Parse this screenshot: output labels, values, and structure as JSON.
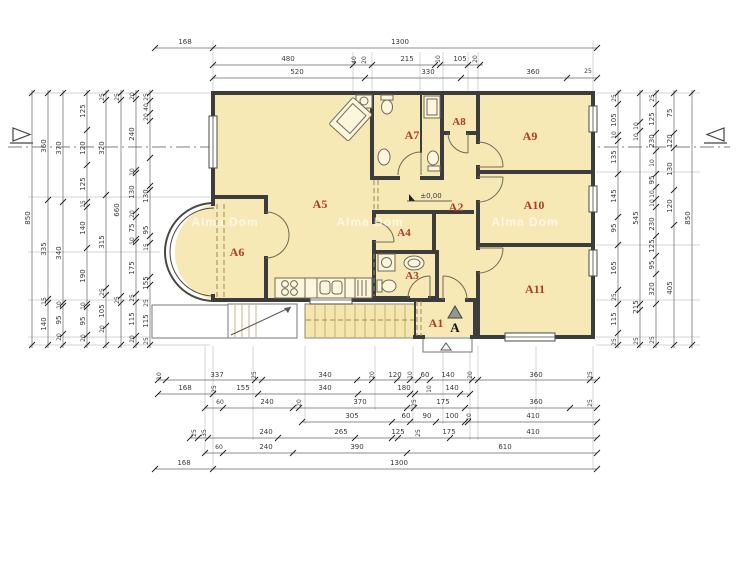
{
  "drawing": {
    "watermark": "Alma Dom",
    "level_marker": "±0,00",
    "section_letter": "A"
  },
  "colors": {
    "room_fill": "#f7e9b5",
    "label_red": "#b03a30",
    "wall": "#3c3c3c",
    "background": "#ffffff"
  },
  "rooms": {
    "a1": "A1",
    "a2": "A2",
    "a3": "A3",
    "a4": "A4",
    "a5": "A5",
    "a6": "A6",
    "a7": "A7",
    "a8": "A8",
    "a9": "A9",
    "a10": "A10",
    "a11": "A11"
  },
  "dims": {
    "t1": [
      "168",
      "1300"
    ],
    "t2": [
      "480",
      "40",
      "20",
      "215",
      "10",
      "105",
      "20"
    ],
    "t3": [
      "520",
      "330",
      "360",
      "25"
    ],
    "b1": [
      "10",
      "337",
      "25",
      "340",
      "20",
      "120",
      "10",
      "60",
      "140",
      "20",
      "360",
      "25"
    ],
    "b2": [
      "168",
      "25",
      "155",
      "340",
      "180",
      "10",
      "140"
    ],
    "b3": [
      "60",
      "240",
      "20",
      "370",
      "25",
      "175",
      "360",
      "25"
    ],
    "b4": [
      "305",
      "60",
      "90",
      "100",
      "10",
      "410"
    ],
    "b5": [
      "25",
      "35",
      "240",
      "265",
      "125",
      "25",
      "175",
      "410"
    ],
    "b6": [
      "60",
      "240",
      "390",
      "610"
    ],
    "b7": [
      "168",
      "1300"
    ],
    "l1": [
      "850"
    ],
    "l2": [
      "360",
      "335",
      "15",
      "140"
    ],
    "l3": [
      "370",
      "340",
      "10",
      "95",
      "20"
    ],
    "l4": [
      "125",
      "120",
      "125",
      "15",
      "140",
      "190",
      "10",
      "95",
      "20"
    ],
    "l5": [
      "25",
      "320",
      "315",
      "25",
      "105",
      "20"
    ],
    "l6": [
      "25",
      "660",
      "25"
    ],
    "l7": [
      "20",
      "240",
      "10",
      "130",
      "20",
      "75",
      "10",
      "175",
      "25",
      "115",
      "20"
    ],
    "l8": [
      "25",
      "40",
      "20",
      "130",
      "95",
      "15",
      "155",
      "25",
      "115",
      "25"
    ],
    "r1": [
      "25",
      "105",
      "10",
      "135",
      "145",
      "95",
      "165",
      "25",
      "115",
      "25"
    ],
    "r2": [
      "10",
      "10",
      "545",
      "215",
      "25"
    ],
    "r3": [
      "25",
      "125",
      "230",
      "10",
      "95",
      "10",
      "10",
      "230",
      "125",
      "95",
      "320",
      "25"
    ],
    "r4": [
      "75",
      "120",
      "130",
      "120",
      "405"
    ],
    "r5": [
      "850"
    ]
  }
}
